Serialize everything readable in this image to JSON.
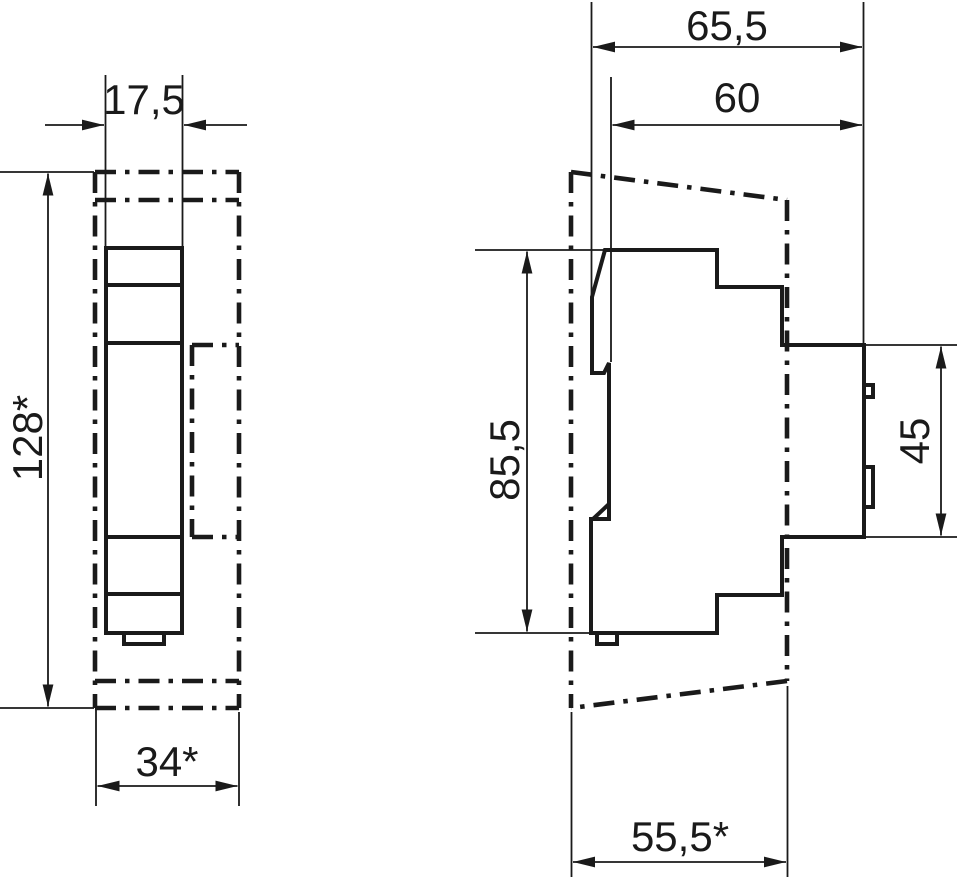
{
  "drawing": {
    "title": "dimension-drawing-two-views",
    "units_shown": "none",
    "colors": {
      "line": "#1a1a1a",
      "background": "#ffffff"
    },
    "front_view": {
      "dim_width_top": "17,5",
      "dim_height_overall": "128*",
      "dim_width_bottom": "34*"
    },
    "side_view": {
      "dim_depth_total": "65,5",
      "dim_depth_body": "60",
      "dim_height_body": "85,5",
      "dim_height_front": "45",
      "dim_depth_bottom": "55,5*"
    }
  }
}
